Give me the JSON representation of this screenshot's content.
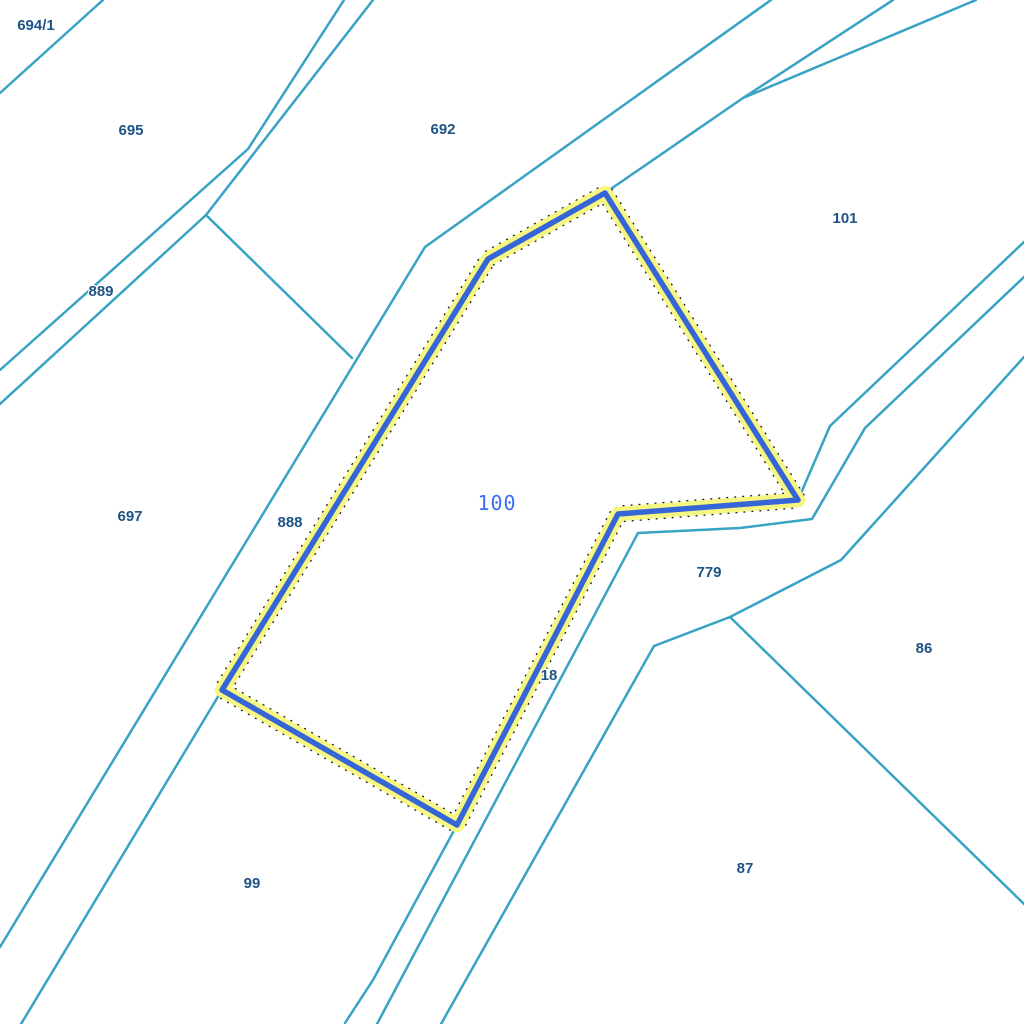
{
  "map": {
    "background_color": "#ffffff",
    "boundary_line_color": "#38a3c4",
    "parcel_label_color": "#1e5385",
    "selected_parcel_label_color": "#3b6ff0",
    "highlight_halo_color": "#f6f682",
    "highlight_core_color": "#3565d6",
    "highlight_dot_color": "#1a1a1a",
    "selected_parcel": {
      "label": "100",
      "label_x": 497,
      "label_y": 510,
      "outline": [
        [
          605,
          193
        ],
        [
          798,
          500
        ],
        [
          618,
          514
        ],
        [
          457,
          825
        ],
        [
          222,
          690
        ],
        [
          488,
          259
        ],
        [
          605,
          193
        ]
      ]
    },
    "labels": [
      {
        "text": "694/1",
        "x": 36,
        "y": 30
      },
      {
        "text": "695",
        "x": 131,
        "y": 135
      },
      {
        "text": "692",
        "x": 443,
        "y": 134
      },
      {
        "text": "101",
        "x": 845,
        "y": 223
      },
      {
        "text": "889",
        "x": 101,
        "y": 296
      },
      {
        "text": "697",
        "x": 130,
        "y": 521
      },
      {
        "text": "888",
        "x": 290,
        "y": 527
      },
      {
        "text": "779",
        "x": 709,
        "y": 577
      },
      {
        "text": "86",
        "x": 924,
        "y": 653
      },
      {
        "text": "18",
        "x": 549,
        "y": 680
      },
      {
        "text": "87",
        "x": 745,
        "y": 873
      },
      {
        "text": "99",
        "x": 252,
        "y": 888
      }
    ],
    "boundary_lines": [
      {
        "points": [
          [
            0,
            93
          ],
          [
            103,
            0
          ]
        ]
      },
      {
        "points": [
          [
            344,
            0
          ],
          [
            248,
            149
          ],
          [
            0,
            370
          ]
        ]
      },
      {
        "points": [
          [
            373,
            0
          ],
          [
            206,
            215
          ],
          [
            0,
            404
          ]
        ]
      },
      {
        "points": [
          [
            206,
            215
          ],
          [
            352,
            358
          ]
        ]
      },
      {
        "points": [
          [
            771,
            0
          ],
          [
            425,
            247
          ],
          [
            0,
            947
          ]
        ]
      },
      {
        "points": [
          [
            893,
            0
          ],
          [
            743,
            98
          ],
          [
            605,
            193
          ]
        ]
      },
      {
        "points": [
          [
            976,
            0
          ],
          [
            743,
            98
          ]
        ]
      },
      {
        "points": [
          [
            1024,
            242
          ],
          [
            830,
            426
          ],
          [
            798,
            500
          ]
        ]
      },
      {
        "points": [
          [
            1024,
            277
          ],
          [
            865,
            428
          ],
          [
            812,
            519
          ],
          [
            740,
            528
          ],
          [
            638,
            533
          ],
          [
            377,
            1024
          ]
        ]
      },
      {
        "points": [
          [
            1024,
            357
          ],
          [
            841,
            560
          ],
          [
            730,
            617
          ],
          [
            654,
            646
          ],
          [
            560,
            813
          ],
          [
            441,
            1024
          ]
        ]
      },
      {
        "points": [
          [
            730,
            617
          ],
          [
            1024,
            904
          ]
        ]
      },
      {
        "points": [
          [
            457,
            825
          ],
          [
            373,
            980
          ],
          [
            345,
            1023
          ]
        ]
      },
      {
        "points": [
          [
            222,
            690
          ],
          [
            21,
            1024
          ]
        ]
      },
      {
        "points": [
          [
            605,
            193
          ],
          [
            798,
            500
          ],
          [
            618,
            514
          ],
          [
            457,
            825
          ],
          [
            222,
            690
          ],
          [
            488,
            259
          ],
          [
            605,
            193
          ]
        ]
      }
    ]
  }
}
